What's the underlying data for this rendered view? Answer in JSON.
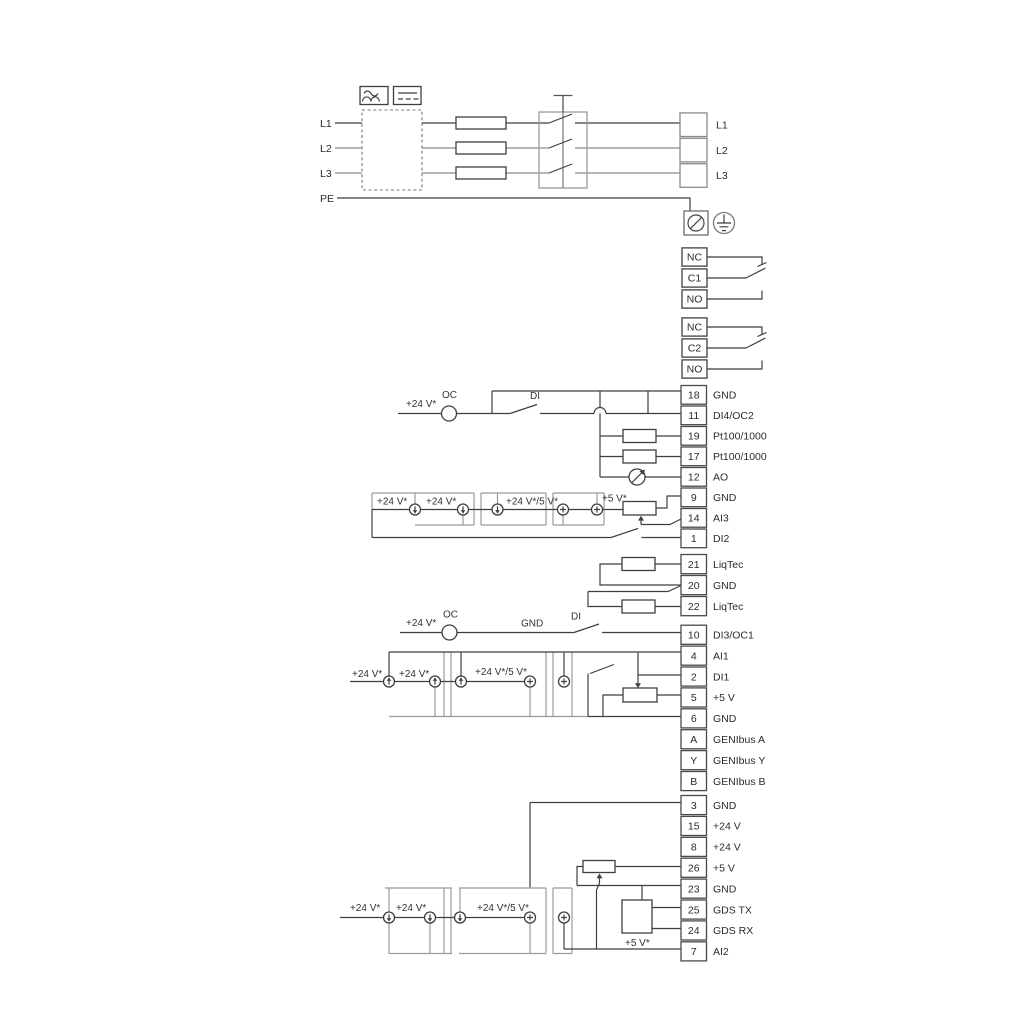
{
  "diagram": {
    "title": "wiring-connection-diagram",
    "power": {
      "inputs": [
        "L1",
        "L2",
        "L3",
        "PE"
      ],
      "outputs": [
        "L1",
        "L2",
        "L3"
      ],
      "icons": {
        "ac": "sine-wave-icon",
        "dc": "solid-dashed-line-icon",
        "pe_terminal": "screened-terminal-icon",
        "earth": "protective-earth-icon",
        "isolator": "three-pole-switch-icon",
        "fuse": "fuse-icon",
        "filter": "dashed-filter-box"
      }
    },
    "relays": [
      {
        "cells": [
          "NC",
          "C1",
          "NO"
        ]
      },
      {
        "cells": [
          "NC",
          "C2",
          "NO"
        ]
      }
    ],
    "strips": {
      "group1": [
        {
          "num": "18",
          "label": "GND"
        },
        {
          "num": "11",
          "label": "DI4/OC2"
        },
        {
          "num": "19",
          "label": "Pt100/1000"
        },
        {
          "num": "17",
          "label": "Pt100/1000"
        },
        {
          "num": "12",
          "label": "AO"
        },
        {
          "num": "9",
          "label": "GND"
        },
        {
          "num": "14",
          "label": "AI3"
        },
        {
          "num": "1",
          "label": "DI2"
        }
      ],
      "group2": [
        {
          "num": "21",
          "label": "LiqTec"
        },
        {
          "num": "20",
          "label": "GND"
        },
        {
          "num": "22",
          "label": "LiqTec"
        }
      ],
      "group3": [
        {
          "num": "10",
          "label": "DI3/OC1"
        },
        {
          "num": "4",
          "label": "AI1"
        },
        {
          "num": "2",
          "label": "DI1"
        },
        {
          "num": "5",
          "label": "+5 V"
        },
        {
          "num": "6",
          "label": "GND"
        },
        {
          "num": "A",
          "label": "GENIbus A"
        },
        {
          "num": "Y",
          "label": "GENIbus Y"
        },
        {
          "num": "B",
          "label": "GENIbus B"
        }
      ],
      "group4": [
        {
          "num": "3",
          "label": "GND"
        },
        {
          "num": "15",
          "label": "+24 V"
        },
        {
          "num": "8",
          "label": "+24 V"
        },
        {
          "num": "26",
          "label": "+5 V"
        },
        {
          "num": "23",
          "label": "GND"
        },
        {
          "num": "25",
          "label": "GDS TX"
        },
        {
          "num": "24",
          "label": "GDS RX"
        },
        {
          "num": "7",
          "label": "AI2"
        }
      ]
    },
    "annotations": {
      "v24": "+24 V*",
      "v24v5": "+24 V*/5 V*",
      "v5": "+5 V*",
      "oc": "OC",
      "di": "DI",
      "gnd": "GND"
    },
    "colors": {
      "wire": "#3f3f3f",
      "light_wire": "#9b9b9b",
      "background": "#ffffff"
    }
  }
}
